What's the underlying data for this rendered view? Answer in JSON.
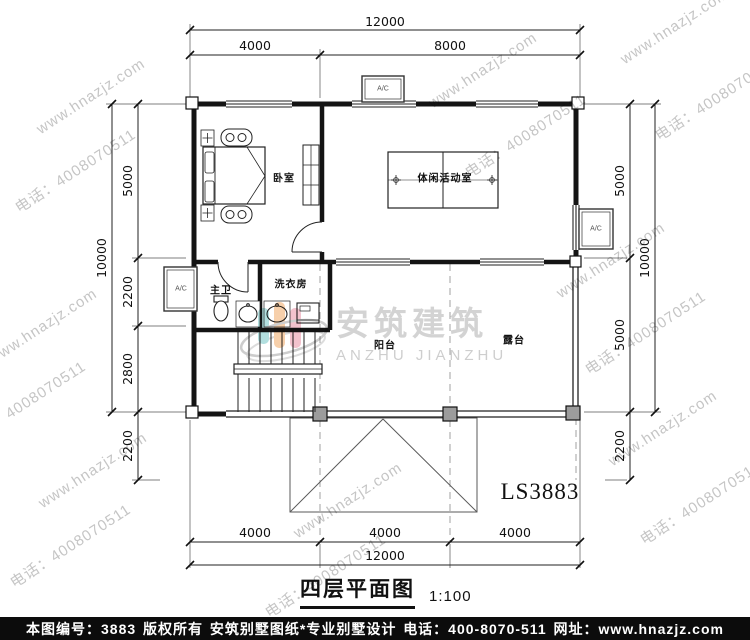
{
  "watermark": {
    "site": "www.hnazjz.com",
    "phone": "电话：4008070511"
  },
  "dims": {
    "top_total": "12000",
    "top_left": "4000",
    "top_right": "8000",
    "bottom_1": "4000",
    "bottom_2": "4000",
    "bottom_3": "4000",
    "bottom_total": "12000",
    "left_total": "10000",
    "left_1": "5000",
    "left_2": "2200",
    "left_3": "2800",
    "left_below": "2200",
    "right_total": "10000",
    "right_1": "5000",
    "right_2": "5000",
    "right_below": "2200"
  },
  "rooms": {
    "bedroom": "卧室",
    "activity": "体闲活动室",
    "master_bath": "主卫",
    "laundry": "洗衣房",
    "balcony": "阳台",
    "terrace": "露台"
  },
  "ac_label": "A/C",
  "model_code": "LS3883",
  "logo": {
    "cn": "安筑建筑",
    "en": "ANZHU JIANZHU"
  },
  "title": {
    "name": "四层平面图",
    "scale": "1:100"
  },
  "footer": {
    "number": "本图编号：3883",
    "copyright": "版权所有",
    "brand": "安筑别墅图纸*专业别墅设计",
    "phone": "电话：400-8070-511",
    "site": "网址：www.hnazjz.com"
  },
  "colors": {
    "logo_teal": "#aadcdc",
    "logo_orange": "#f7cba2",
    "logo_pink": "#f2bcc8",
    "footer_bg": "#0c0c0c"
  }
}
